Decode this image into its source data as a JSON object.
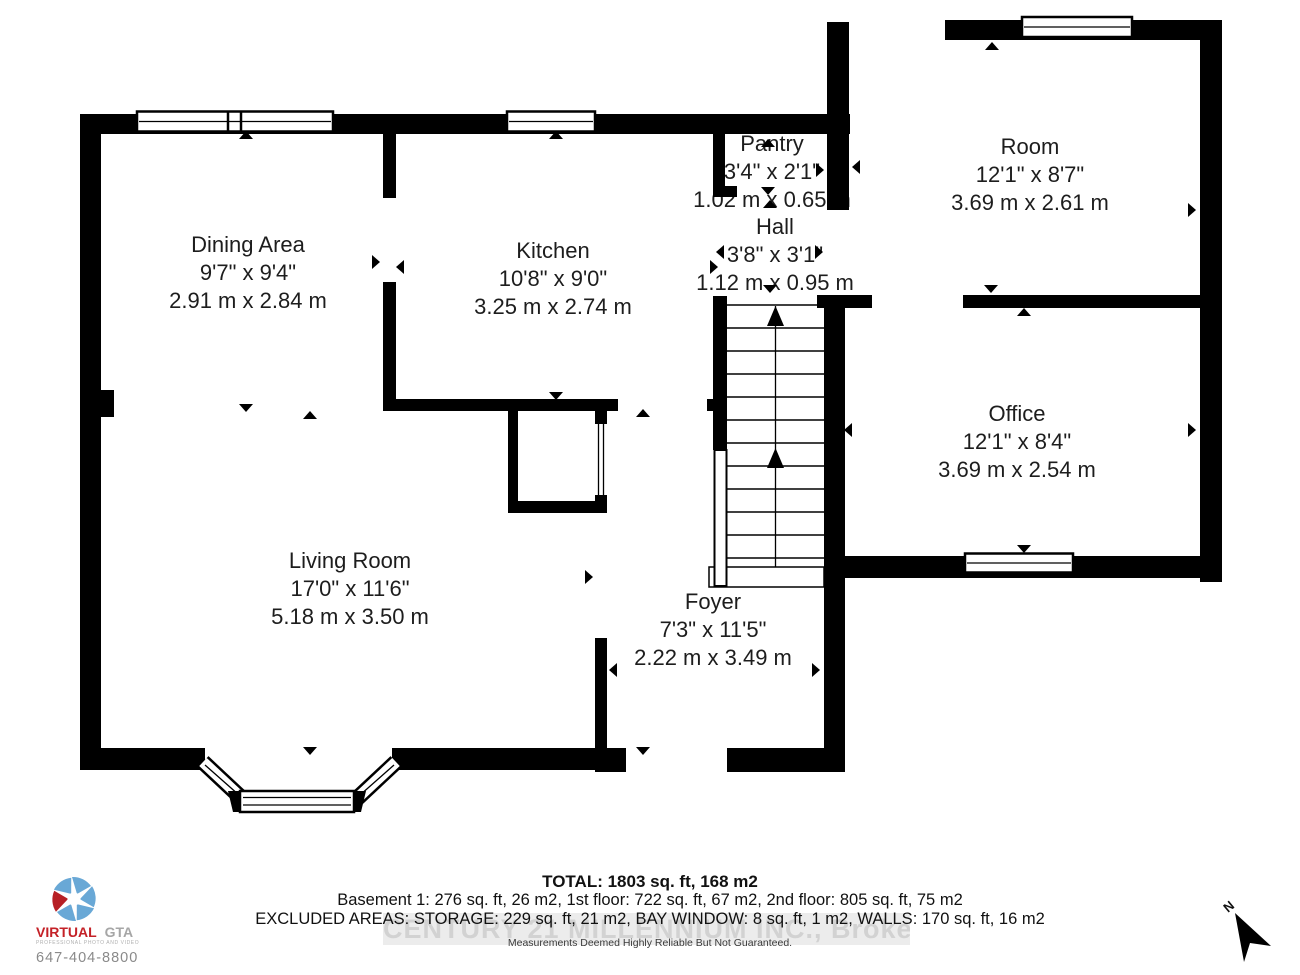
{
  "plan": {
    "rooms": [
      {
        "name": "Dining Area",
        "imperial": "9'7\" x 9'4\"",
        "metric": "2.91 m x 2.84 m"
      },
      {
        "name": "Kitchen",
        "imperial": "10'8\" x 9'0\"",
        "metric": "3.25 m x 2.74 m"
      },
      {
        "name": "Pantry",
        "imperial": "3'4\" x 2'1\"",
        "metric": "1.02 m x 0.65 m"
      },
      {
        "name": "Hall",
        "imperial": "3'8\" x 3'1\"",
        "metric": "1.12 m x 0.95 m"
      },
      {
        "name": "Room",
        "imperial": "12'1\" x 8'7\"",
        "metric": "3.69 m x 2.61 m"
      },
      {
        "name": "Office",
        "imperial": "12'1\" x 8'4\"",
        "metric": "3.69 m x 2.54 m"
      },
      {
        "name": "Living Room",
        "imperial": "17'0\" x 11'6\"",
        "metric": "5.18 m x 3.50 m"
      },
      {
        "name": "Foyer",
        "imperial": "7'3\" x 11'5\"",
        "metric": "2.22 m x 3.49 m"
      }
    ],
    "north_label": "N"
  },
  "summary": {
    "total": "TOTAL: 1803 sq. ft, 168 m2",
    "floors": "Basement 1: 276 sq. ft, 26 m2, 1st floor: 722 sq. ft, 67 m2, 2nd floor: 805 sq. ft, 75 m2",
    "excluded": "EXCLUDED AREAS: STORAGE: 229 sq. ft, 21 m2, BAY WINDOW: 8 sq. ft, 1 m2, WALLS: 170 sq. ft, 16 m2",
    "disclaimer": "Measurements Deemed Highly Reliable But Not Guaranteed.",
    "watermark": "CENTURY 21 MILLENNIUM INC., Brokerage"
  },
  "logo": {
    "brand_primary": "VIRTUAL",
    "brand_secondary": "GTA",
    "tagline": "PROFESSIONAL PHOTO AND VIDEO",
    "phone": "647-404-8800",
    "colors": {
      "blue": "#69a8d6",
      "red": "#b72025",
      "gray": "#a6a6a6"
    }
  }
}
